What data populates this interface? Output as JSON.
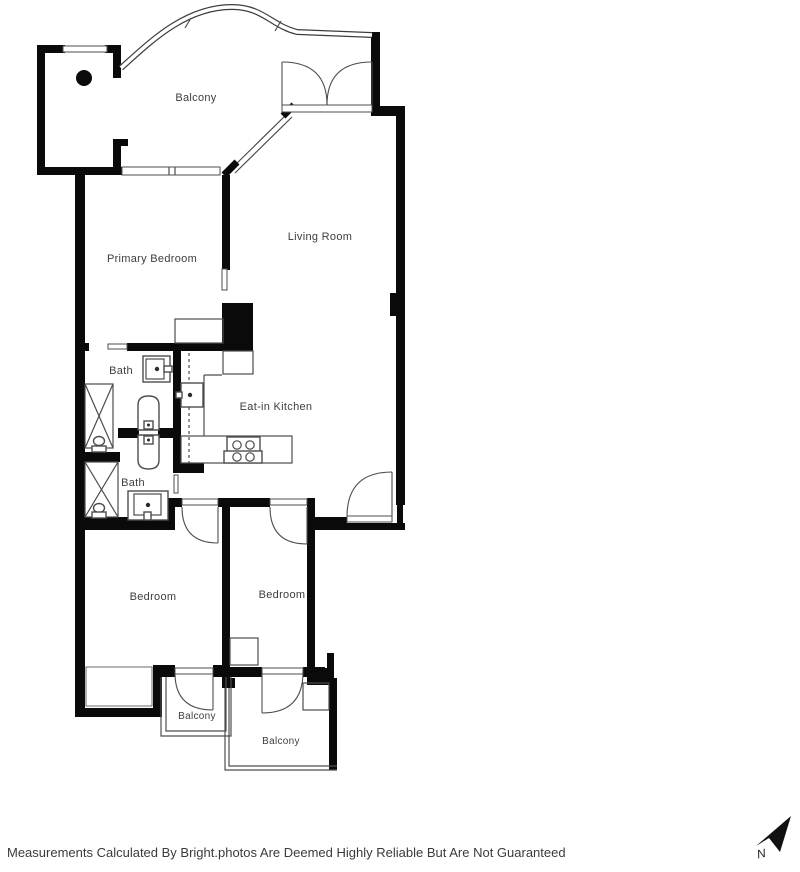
{
  "rooms": {
    "balcony_top": "Balcony",
    "primary_bedroom": "Primary Bedroom",
    "living_room": "Living Room",
    "bath_1": "Bath",
    "eat_in_kitchen": "Eat-in Kitchen",
    "bath_2": "Bath",
    "bedroom_left": "Bedroom",
    "bedroom_right": "Bedroom",
    "balcony_left": "Balcony",
    "balcony_right": "Balcony"
  },
  "compass": {
    "north_label": "N"
  },
  "footer": {
    "disclaimer": "Measurements Calculated By Bright.photos Are Deemed Highly Reliable But Are Not Guaranteed"
  },
  "colors": {
    "wall": "#0a0a0a",
    "fixture_line": "#4d4d4d",
    "label_text": "#3d3d3d",
    "background": "#ffffff"
  }
}
